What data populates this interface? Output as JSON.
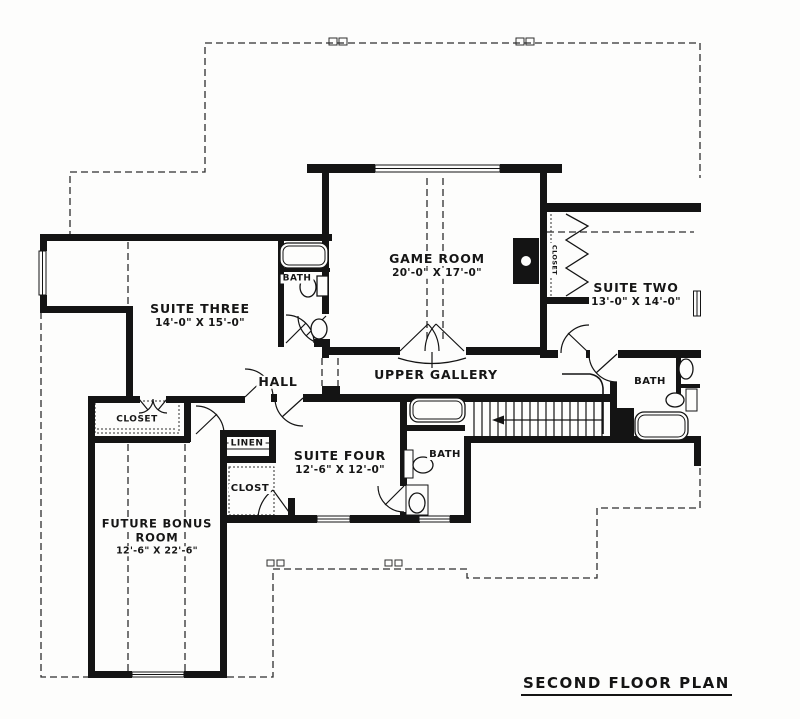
{
  "title": "SECOND FLOOR PLAN",
  "rooms": {
    "game_room": {
      "name": "GAME ROOM",
      "dims": "20'-0\" X 17'-0\""
    },
    "suite_two": {
      "name": "SUITE TWO",
      "dims": "13'-0\" X 14'-0\""
    },
    "suite_three": {
      "name": "SUITE THREE",
      "dims": "14'-0\" X 15'-0\""
    },
    "suite_four": {
      "name": "SUITE FOUR",
      "dims": "12'-6\" X 12'-0\""
    },
    "future_bonus_room": {
      "name_line1": "FUTURE BONUS",
      "name_line2": "ROOM",
      "dims": "12'-6\" X 22'-6\""
    },
    "upper_gallery": {
      "name": "UPPER GALLERY"
    },
    "hall": {
      "name": "HALL"
    }
  },
  "labels": {
    "bath_suite_three": "BATH",
    "bath_suite_two": "BATH",
    "bath_suite_four": "BATH",
    "closet_suite_three": "CLOSET",
    "closet_game_room": "CLOSET",
    "closet_suite_four": "CLOST",
    "linen": "LINEN"
  },
  "colors": {
    "ink": "#141414",
    "paper": "#fdfdfc"
  }
}
